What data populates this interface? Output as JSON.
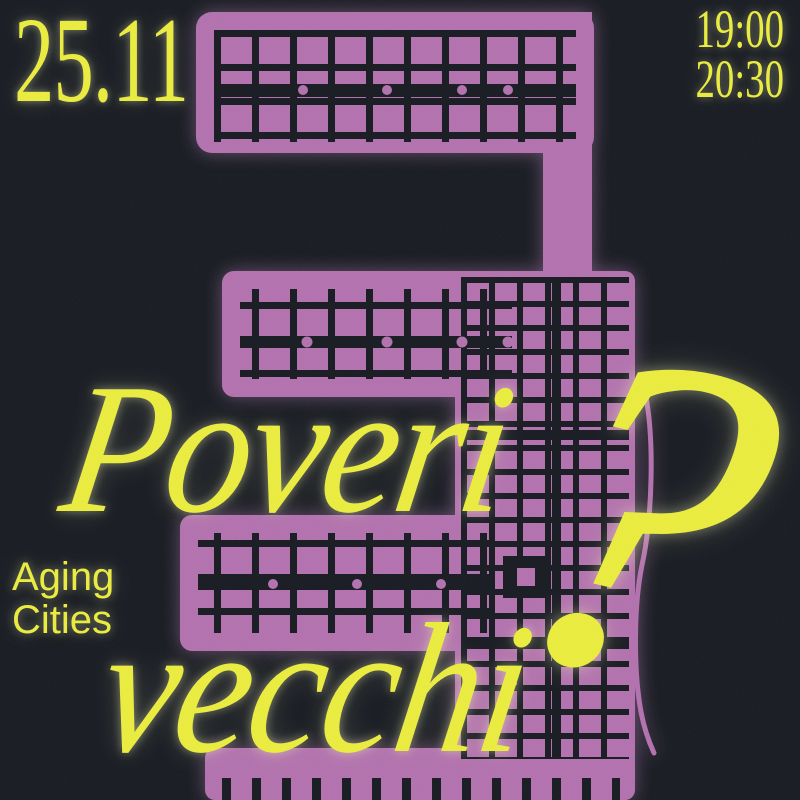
{
  "poster": {
    "date": "25.11",
    "times": {
      "start": "19:00",
      "end": "20:30"
    },
    "headline": {
      "word1": "Poveri",
      "word2": "vecchi",
      "punctuation": "?"
    },
    "subtitle": {
      "line1": "Aging",
      "line2": "Cities"
    },
    "graphic": {
      "name": "city-map-shaped-like-number-3"
    },
    "colors": {
      "background": "#171a21",
      "accent_yellow": "#e9eb3d",
      "map_purple": "#b170ad"
    }
  }
}
